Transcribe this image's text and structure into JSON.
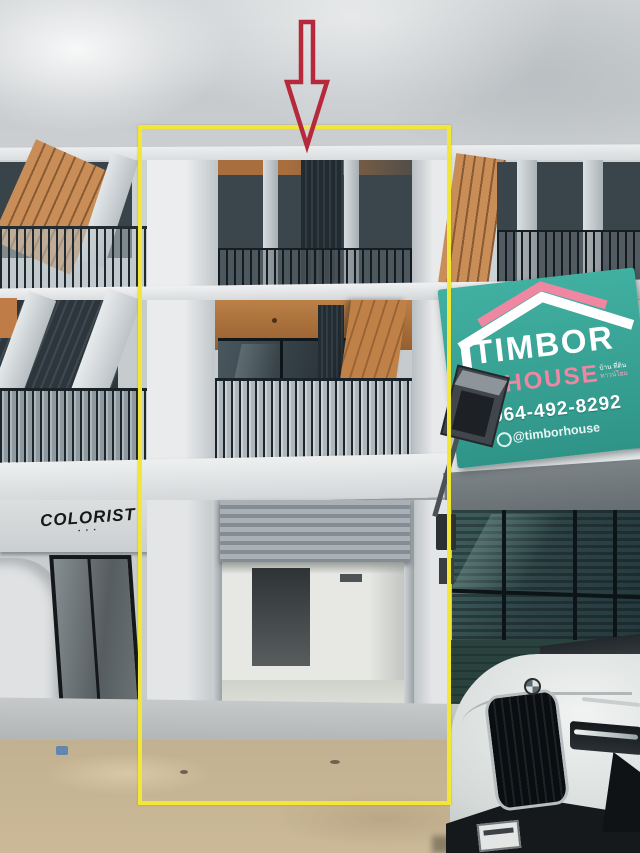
{
  "image": {
    "kind": "real-estate-photo",
    "subject": "Three-storey townhome shophouse; middle unit highlighted for sale"
  },
  "annotations": {
    "highlight_box": {
      "shape": "rectangle",
      "color": "#f2e636"
    },
    "pointer_arrow": {
      "shape": "down-arrow-outline",
      "color": "#b5293b"
    }
  },
  "timbor_sign": {
    "brand_top": "TIMBOR",
    "brand_bottom": "HOUSE",
    "tagline_line1": "บ้าน ที่ดิน",
    "tagline_line2": "ทาวน์โฮม",
    "phone": "064-492-8292",
    "handle": "@timborhouse",
    "bg_color": "#3aa396",
    "accent_pink": "#ef87a2"
  },
  "colorist_sign": {
    "name": "COLORIST",
    "subtext": "• • •"
  },
  "scene": {
    "building_color": "#d5d9db",
    "wood_accent": "#c08148",
    "shutter_color": "#97a1a8",
    "right_shutter_color": "#2a423d",
    "ground_color": "#c9b795",
    "car": "white SUV front"
  }
}
